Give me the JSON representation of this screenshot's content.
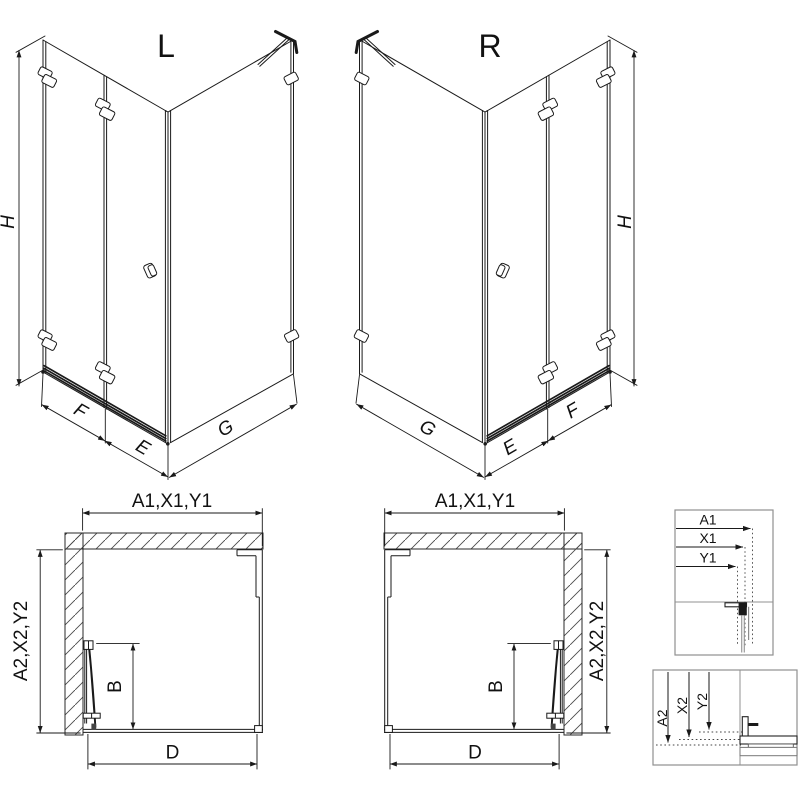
{
  "colors": {
    "line": "#1a1a1a",
    "detail_border": "#909090",
    "background": "#ffffff"
  },
  "iso_left": {
    "variant_label": "L",
    "height_label": "H",
    "front_fixed_label": "F",
    "front_door_label": "E",
    "side_label": "G"
  },
  "iso_right": {
    "variant_label": "R",
    "height_label": "H",
    "front_fixed_label": "F",
    "front_door_label": "E",
    "side_label": "G"
  },
  "plan_left": {
    "width_label": "A1,X1,Y1",
    "depth_label": "A2,X2,Y2",
    "door_width_label": "B",
    "entry_width_label": "D"
  },
  "plan_right": {
    "width_label": "A1,X1,Y1",
    "depth_label": "A2,X2,Y2",
    "door_width_label": "B",
    "entry_width_label": "D"
  },
  "detail_width": {
    "labels": [
      "A1",
      "X1",
      "Y1"
    ]
  },
  "detail_depth": {
    "labels": [
      "A2",
      "X2",
      "Y2"
    ]
  }
}
